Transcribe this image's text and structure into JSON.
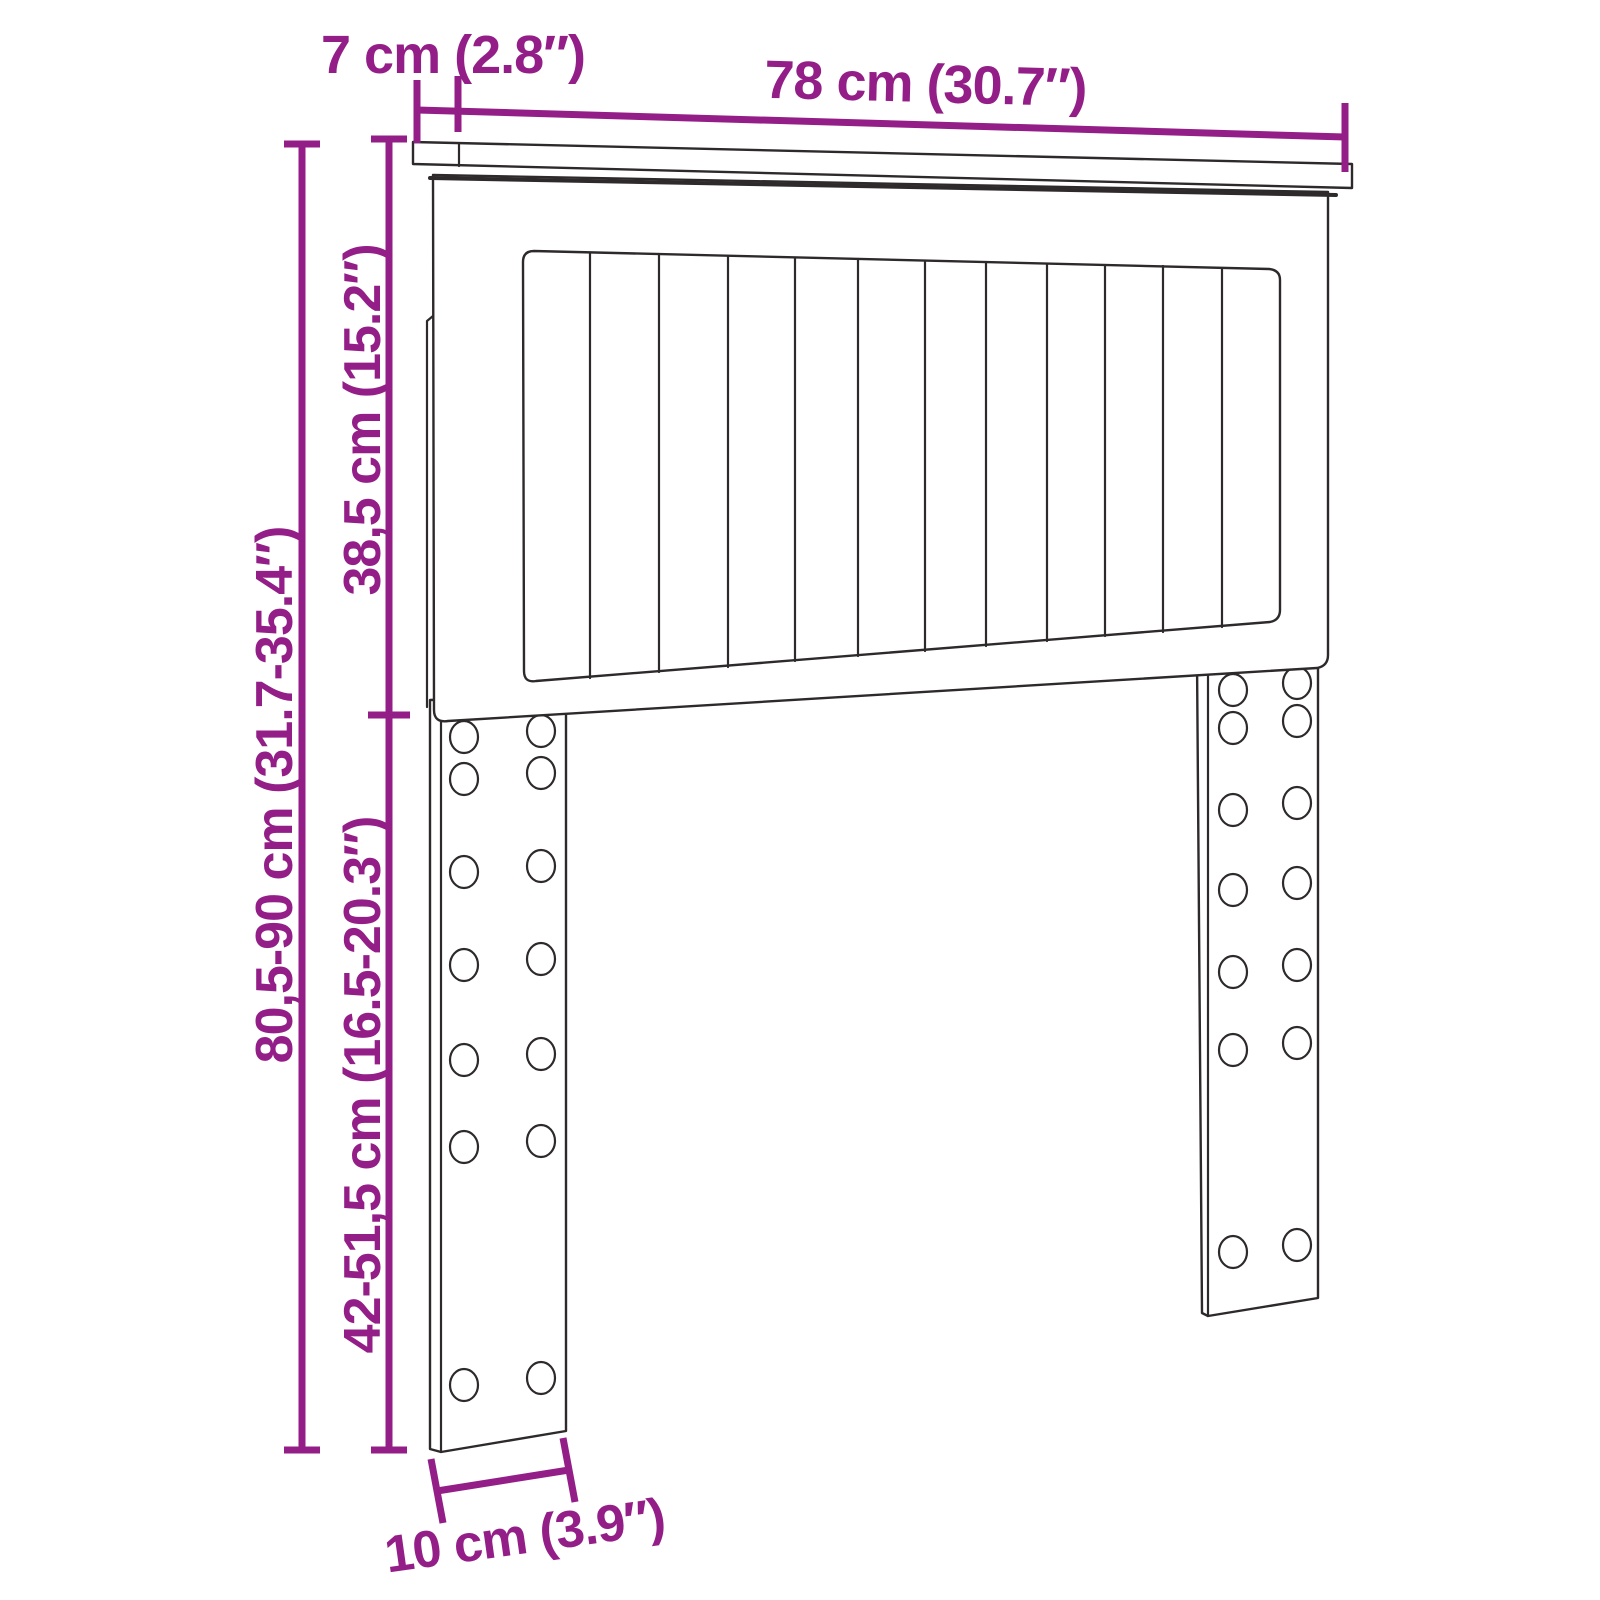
{
  "title": "Headboard dimension diagram",
  "figure": {
    "type": "headboard-with-legs",
    "slat_count": 12,
    "bolt_holes_per_leg": 14
  },
  "colors": {
    "dimension": "#941E87",
    "outline": "#2E2A2B",
    "background": "#FFFFFF"
  },
  "dimensions": {
    "shelf_depth": {
      "label": "7 cm (2.8″)"
    },
    "width": {
      "label": "78 cm (30.7″)"
    },
    "upper_height": {
      "label": "38,5 cm (15.2″)"
    },
    "total_height": {
      "label": "80,5-90 cm (31.7-35.4″)"
    },
    "leg_height": {
      "label": "42-51,5 cm (16.5-20.3″)"
    },
    "leg_width": {
      "label": "10 cm (3.9″)"
    }
  }
}
